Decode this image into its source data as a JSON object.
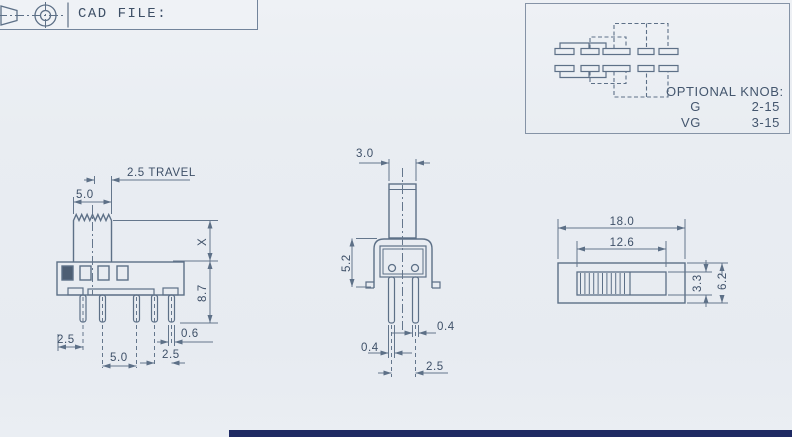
{
  "title_block": {
    "label": "CAD FILE:",
    "symbol": "third-angle-projection-icon"
  },
  "optional_knob": {
    "heading": "OPTIONAL KNOB:",
    "options": [
      {
        "label": "G",
        "value": "2-15"
      },
      {
        "label": "VG",
        "value": "3-15"
      }
    ],
    "schematic": "slide-switch-circuit-diagram"
  },
  "dims": {
    "side": {
      "travel": "2.5 TRAVEL",
      "knob_width": "5.0",
      "knob_height": "X",
      "body_height": "8.7",
      "pin_offset_left": "2.5",
      "pin_span_center": "5.0",
      "pin_span_right": "2.5",
      "pin_width": "0.6"
    },
    "front": {
      "knob_width": "3.0",
      "body_height": "5.2",
      "pin_thickness_left": "0.4",
      "pin_thickness_right": "0.4",
      "pin_spacing": "2.5"
    },
    "top": {
      "overall_length": "18.0",
      "slot_length": "12.6",
      "slot_width": "3.3",
      "body_width": "6.2"
    }
  },
  "colors": {
    "paper": "#e9edf2",
    "line": "#5d7087",
    "text": "#3e5068",
    "accent_bar": "#1f2a63"
  }
}
